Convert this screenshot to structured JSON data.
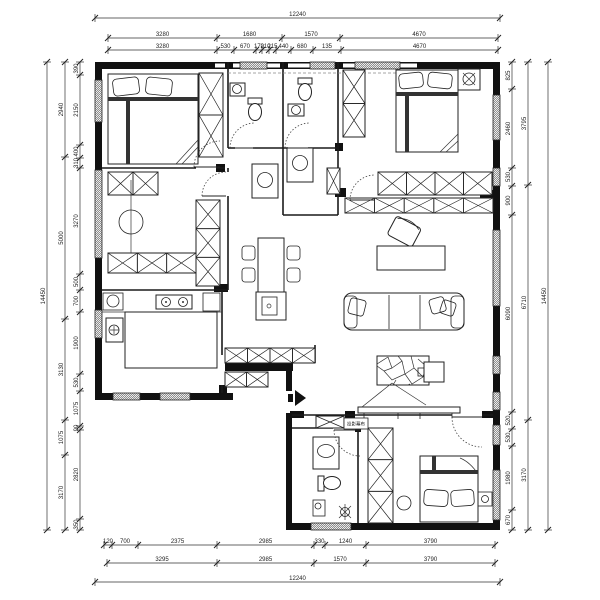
{
  "title": "residential apartment floor plan",
  "colors": {
    "line": "#1a1a1a",
    "wall_fill": "#111111",
    "background": "#ffffff"
  },
  "dims": {
    "top_overall": [
      "12240"
    ],
    "top_row2": [
      "3280",
      "1680",
      "1570",
      "4670"
    ],
    "top_row3": [
      "3280",
      "530",
      "670",
      "170",
      "210",
      "215",
      "440",
      "680",
      "135",
      "4670"
    ],
    "bottom_row1": [
      "120",
      "700",
      "2375",
      "2985",
      "330",
      "1240",
      "3790"
    ],
    "bottom_row2": [
      "3295",
      "2985",
      "1570",
      "3790"
    ],
    "bottom_overall": [
      "12240"
    ],
    "left_overall": [
      "14450"
    ],
    "left_outer": [
      "2940",
      "5000",
      "3130",
      "1075",
      "3170"
    ],
    "left_inner": [
      "390",
      "2150",
      "400",
      "310",
      "3270",
      "500",
      "700",
      "1900",
      "530",
      "1075",
      "90",
      "2820",
      "350"
    ],
    "right_overall": [
      "14450"
    ],
    "right_outer": [
      "3795",
      "6710",
      "3170"
    ],
    "right_inner": [
      "825",
      "2460",
      "530",
      "900",
      "6090",
      "520",
      "530",
      "1980",
      "670"
    ]
  },
  "annotations": {
    "equipment_label": "投影幕布"
  }
}
